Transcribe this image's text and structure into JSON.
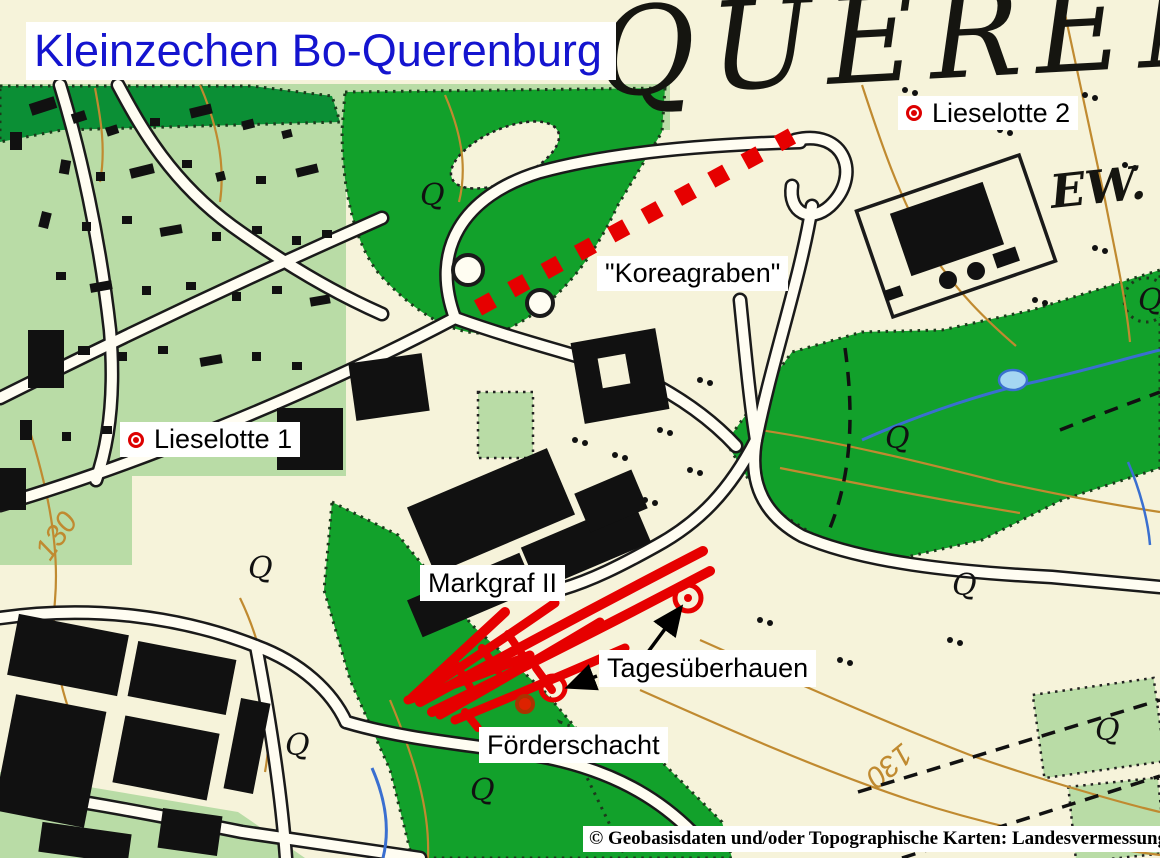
{
  "title": {
    "text": "Kleinzechen Bo-Querenburg",
    "color": "#1414cf"
  },
  "annotations": {
    "lieselotte2": "Lieselotte 2",
    "koreagraben": "\"Koreagraben\"",
    "lieselotte1": "Lieselotte 1",
    "markgraf": "Markgraf II",
    "tagesueberhauen": "Tagesüberhauen",
    "foerderschacht": "Förderschacht"
  },
  "map_text": {
    "big_place_name": "QUEREN",
    "place_fragment": "EW.",
    "contour_value_left": "130",
    "contour_value_right": "130",
    "tree_symbol": "Q"
  },
  "copyright": "© Geobasisdaten und/oder Topographische Karten: Landesvermessung NRW, Bonn",
  "legend_semantics": {
    "red_dashed_line": "Koreagraben trench trace",
    "red_line_bundle": "mine galleries Markgraf II",
    "ring_marker": "Tagesüberhauen (day raise)",
    "filled_marker": "Förderschacht (hoisting shaft)",
    "dot_ring_marker": "shaft Lieselotte"
  },
  "colors": {
    "paper_cream": "#f6f3da",
    "road_fill": "#fffdf2",
    "residential_green": "#b9dca6",
    "forest_green": "#12a12b",
    "dark_forest_green": "#0b8f35",
    "overlay_red": "#e60000",
    "title_blue": "#1414cf",
    "contour_brown": "#c08a30",
    "stream_blue": "#3a6fd0",
    "pond_blue": "#a5d6f2",
    "building_black": "#111111"
  }
}
